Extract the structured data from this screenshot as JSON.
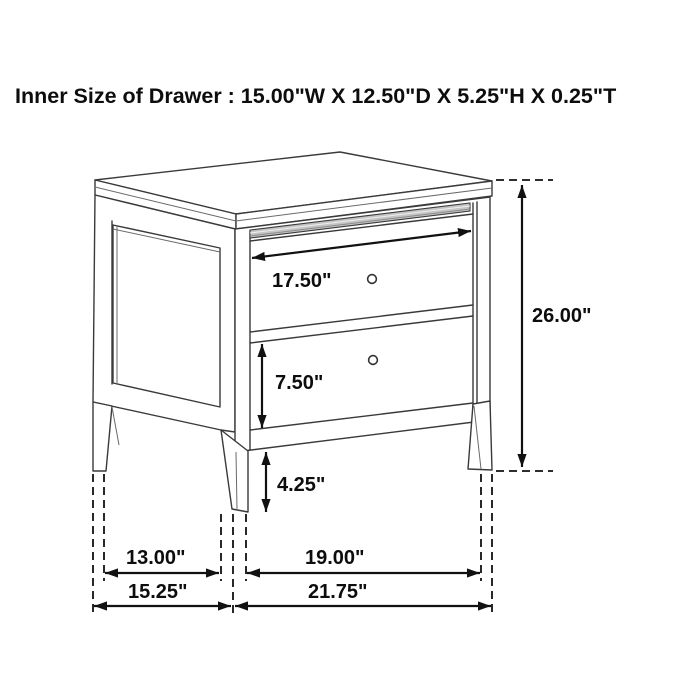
{
  "title": "Inner Size of Drawer : 15.00\"W X 12.50\"D X 5.25\"H X 0.25\"T",
  "diagram": {
    "subject": "two-drawer nightstand dimension drawing",
    "style": {
      "line_color": "#3a3a3a",
      "dimension_color": "#111111",
      "drawer_lip_color": "#c5c5c5",
      "background": "#ffffff"
    },
    "labels": {
      "drawer_width": "17.50\"",
      "overall_height": "26.00\"",
      "drawer_height": "7.50\"",
      "leg_height": "4.25\"",
      "side_leg_gap": "13.00\"",
      "front_leg_gap": "19.00\"",
      "overall_depth": "15.25\"",
      "overall_width": "21.75\""
    }
  }
}
